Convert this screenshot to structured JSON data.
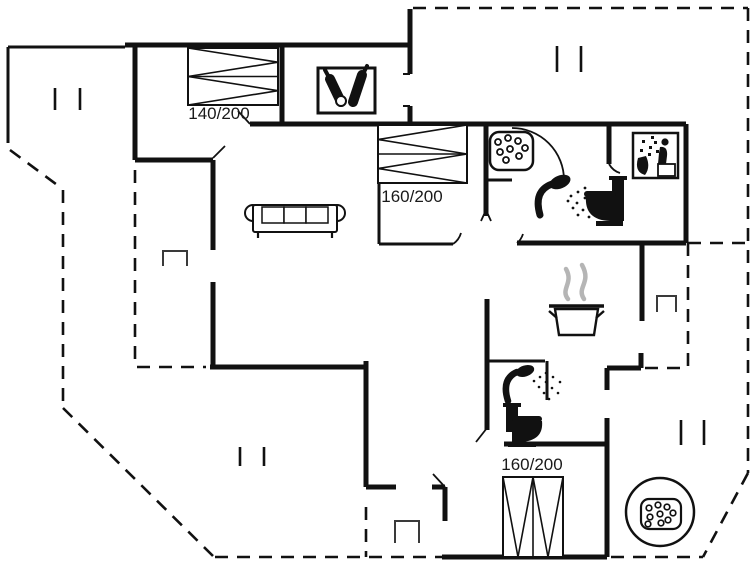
{
  "floorplan": {
    "bed_labels": [
      {
        "id": "bed-1",
        "size": "140/200"
      },
      {
        "id": "bed-2",
        "size": "160/200"
      },
      {
        "id": "bed-3",
        "size": "160/200"
      }
    ],
    "icons": [
      "double-bed",
      "sofa",
      "wine-bottles",
      "washing-machine",
      "sauna",
      "shower",
      "toilet",
      "cooking-pot",
      "steam",
      "whirlpool",
      "window-marker",
      "niche-marker",
      "door-swing"
    ],
    "colors": {
      "wall": "#111111",
      "background": "#ffffff",
      "steam": "#b5b5b5",
      "label_text": "#1a1a1a"
    }
  }
}
